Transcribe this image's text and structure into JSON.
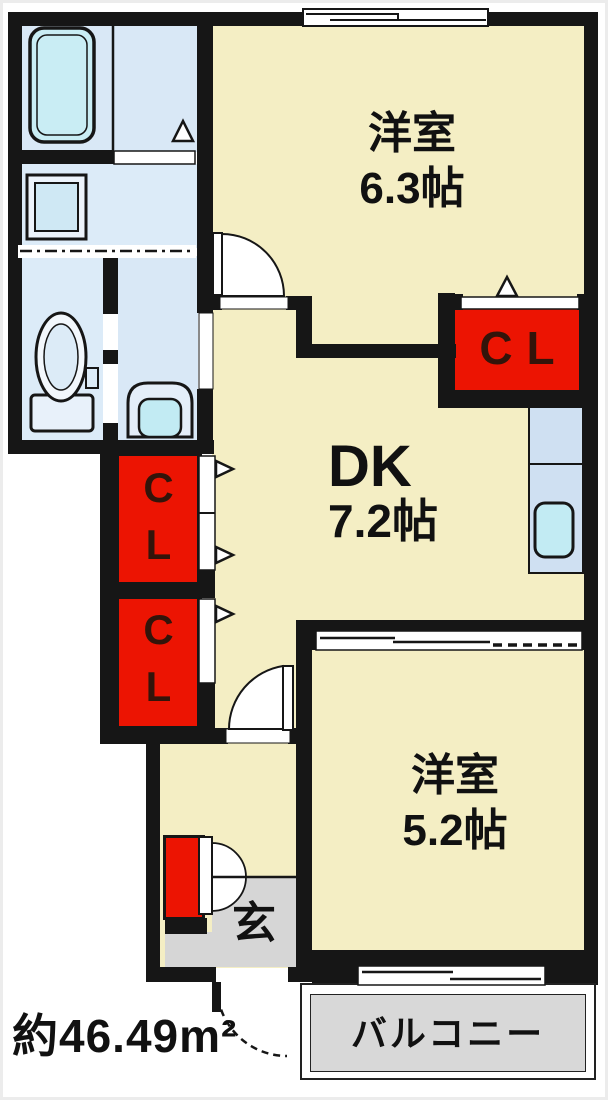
{
  "floor_plan": {
    "area_label": "約46.49m²",
    "rooms": {
      "west_room_1": {
        "name": "洋室",
        "size": "6.3帖"
      },
      "dining_kitchen": {
        "name": "DK",
        "size": "7.2帖"
      },
      "west_room_2": {
        "name": "洋室",
        "size": "5.2帖"
      },
      "entrance": {
        "label": "玄"
      },
      "balcony": {
        "label": "バルコニー"
      }
    },
    "closets": {
      "right_label": "CL",
      "left_top_label": "CL",
      "left_bottom_label": "CL"
    },
    "fixtures": [
      "bathtub",
      "washing-machine-pan",
      "toilet",
      "washbasin",
      "kitchen-sink",
      "shoe-cabinet"
    ],
    "colors": {
      "room_cream": "#f4eec4",
      "wet_area_blue": "#d9e8f6",
      "fixture_teal": "#c2ebf3",
      "closet_red": "#ec1402",
      "entrance_gray": "#d6d6d6",
      "balcony_gray": "#d8d8d8",
      "wall_black": "#161616",
      "text_black": "#111111",
      "closet_text": "#33140a"
    }
  }
}
